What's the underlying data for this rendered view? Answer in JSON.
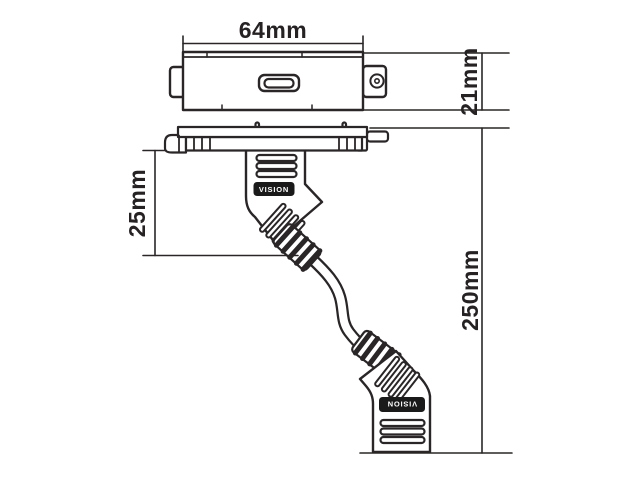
{
  "diagram": {
    "dimensions": {
      "plate_width": "64mm",
      "plate_height": "21mm",
      "connector_drop": "25mm",
      "overall_length": "250mm"
    },
    "brand": {
      "top_connector_label": "VISION",
      "bottom_connector_label": "VISION"
    },
    "colors": {
      "line": "#2a2627",
      "background": "#ffffff",
      "label_background": "#1a1a1a",
      "label_text": "#ffffff"
    }
  }
}
